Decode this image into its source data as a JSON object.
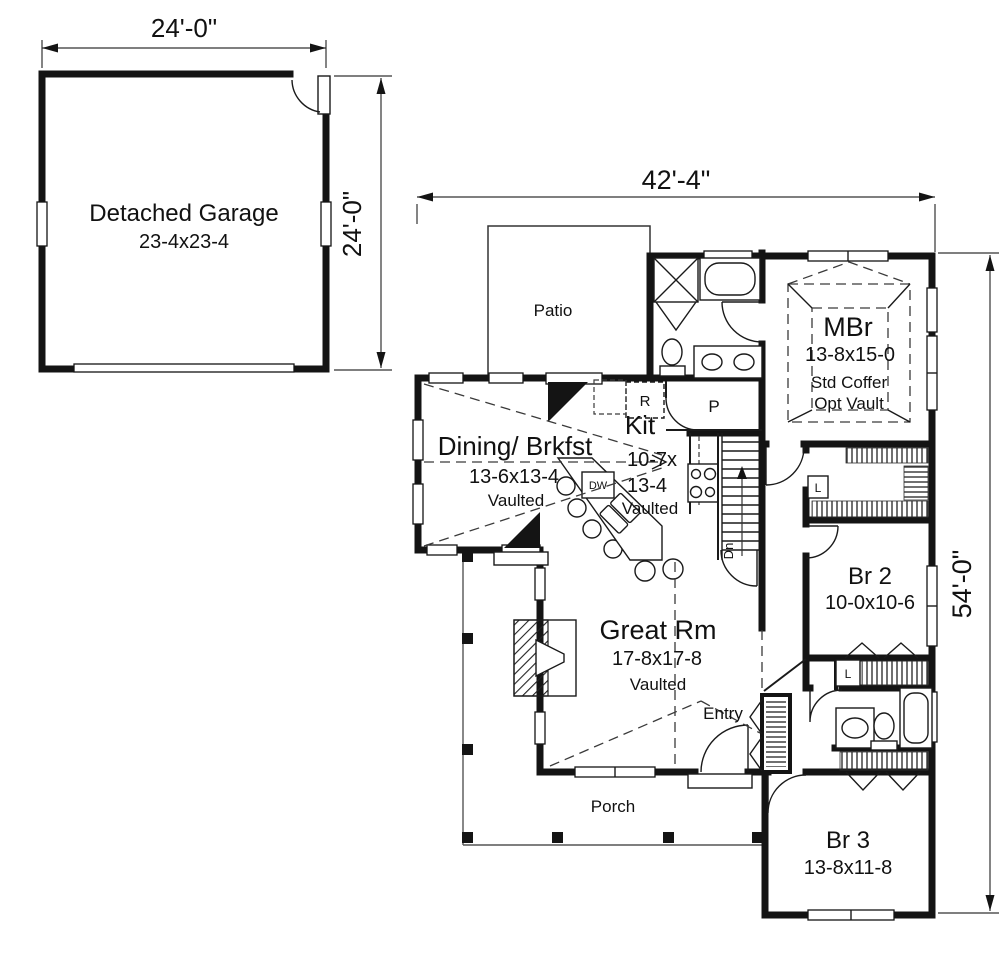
{
  "garage": {
    "name": "Detached Garage",
    "size": "23-4x23-4",
    "width_dim": "24'-0\"",
    "depth_dim": "24'-0\""
  },
  "house": {
    "width_dim": "42'-4\"",
    "depth_dim": "54'-0\""
  },
  "rooms": {
    "patio": {
      "label": "Patio"
    },
    "mbr": {
      "label": "MBr",
      "size": "13-8x15-0",
      "ceiling1": "Std Coffer",
      "ceiling2": "Opt Vault"
    },
    "kitchen": {
      "label": "Kit",
      "size_line1": "10-7x",
      "size_line2": "13-4",
      "ceiling": "Vaulted"
    },
    "dining": {
      "label": "Dining/ Brkfst",
      "size": "13-6x13-4",
      "ceiling": "Vaulted"
    },
    "great_room": {
      "label": "Great Rm",
      "size": "17-8x17-8",
      "ceiling": "Vaulted"
    },
    "br2": {
      "label": "Br 2",
      "size": "10-0x10-6"
    },
    "br3": {
      "label": "Br 3",
      "size": "13-8x11-8"
    },
    "entry": {
      "label": "Entry"
    },
    "porch": {
      "label": "Porch"
    }
  },
  "markers": {
    "refrigerator": "R",
    "pantry": "P",
    "dishwasher": "DW",
    "linen": "L",
    "stairs": "Dn"
  }
}
